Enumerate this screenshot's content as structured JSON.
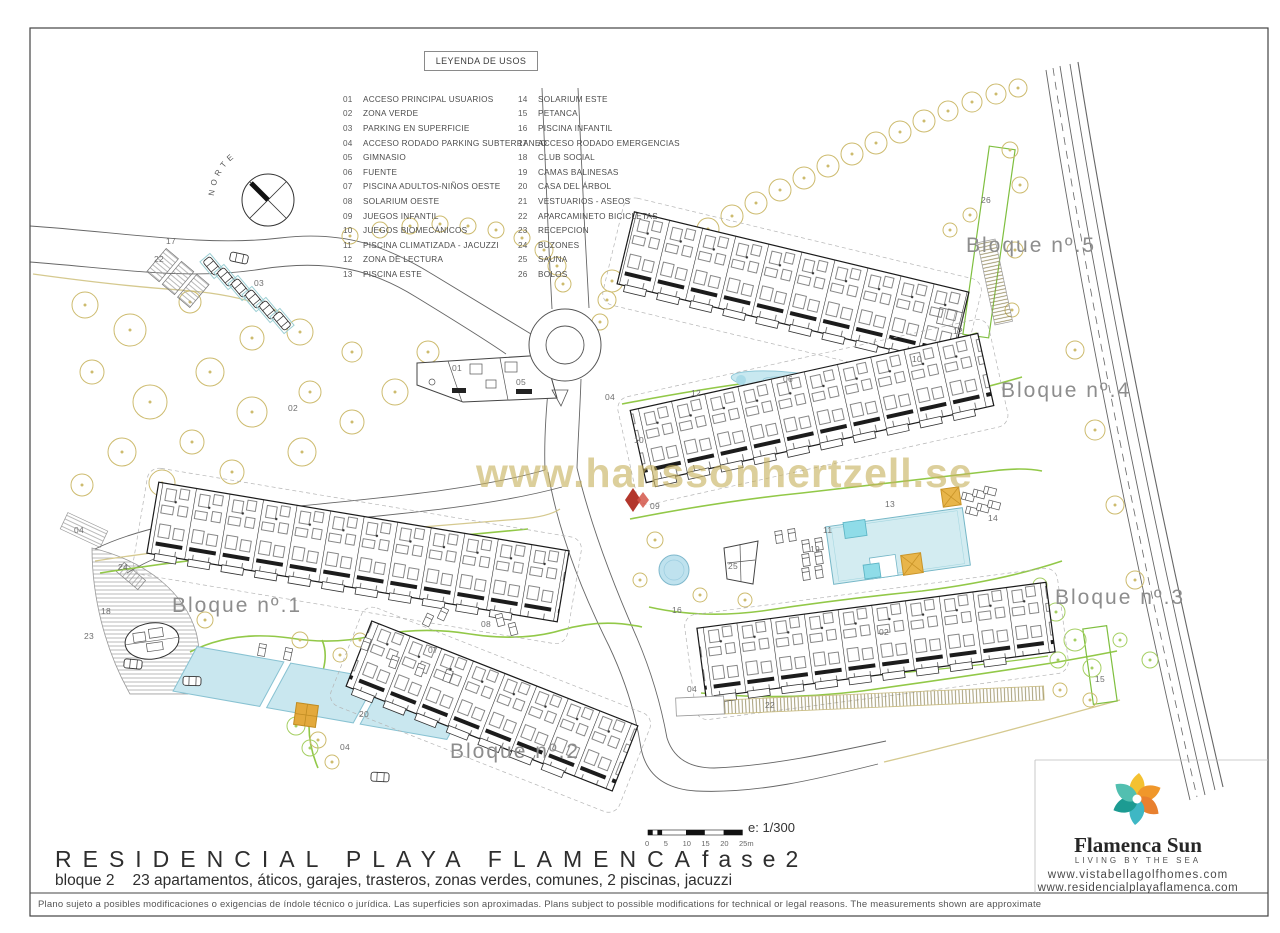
{
  "page": {
    "title_main": "RESIDENCIAL PLAYA FLAMENCA",
    "title_phase": "fase2",
    "subtitle_block": "bloque 2",
    "subtitle_rest": "23 apartamentos, áticos, garajes, trasteros, zonas verdes, comunes, 2 piscinas, jacuzzi",
    "disclaimer": "Plano sujeto a posibles modificaciones o exigencias de índole técnico o jurídica. Las superficies son aproximadas. Plans subject to possible modifications for technical or legal reasons. The measurements shown are approximate"
  },
  "legend": {
    "title": "LEYENDA DE USOS",
    "columns": [
      [
        {
          "num": "01",
          "label": "ACCESO PRINCIPAL USUARIOS"
        },
        {
          "num": "02",
          "label": "ZONA VERDE"
        },
        {
          "num": "03",
          "label": "PARKING EN SUPERFICIE"
        },
        {
          "num": "04",
          "label": "ACCESO RODADO PARKING SUBTERRANEO"
        },
        {
          "num": "05",
          "label": "GIMNASIO"
        },
        {
          "num": "06",
          "label": "FUENTE"
        },
        {
          "num": "07",
          "label": "PISCINA ADULTOS-NIÑOS OESTE"
        },
        {
          "num": "08",
          "label": "SOLARIUM OESTE"
        },
        {
          "num": "09",
          "label": "JUEGOS INFANTIL"
        },
        {
          "num": "10",
          "label": "JUEGOS BIOMECÁNICOS"
        },
        {
          "num": "11",
          "label": "PISCINA CLIMATIZADA - JACUZZI"
        },
        {
          "num": "12",
          "label": "ZONA DE LECTURA"
        },
        {
          "num": "13",
          "label": "PISCINA ESTE"
        }
      ],
      [
        {
          "num": "14",
          "label": "SOLARIUM ESTE"
        },
        {
          "num": "15",
          "label": "PETANCA"
        },
        {
          "num": "16",
          "label": "PISCINA INFANTIL"
        },
        {
          "num": "17",
          "label": "ACCESO RODADO EMERGENCIAS"
        },
        {
          "num": "18",
          "label": "CLUB SOCIAL"
        },
        {
          "num": "19",
          "label": "CAMAS BALINESAS"
        },
        {
          "num": "20",
          "label": "CASA DEL ÁRBOL"
        },
        {
          "num": "21",
          "label": "VESTUARIOS - ASEOS"
        },
        {
          "num": "22",
          "label": "APARCAMINETO BICICLETAS"
        },
        {
          "num": "23",
          "label": "RECEPCION"
        },
        {
          "num": "24",
          "label": "BUZONES"
        },
        {
          "num": "25",
          "label": "SAUNA"
        },
        {
          "num": "26",
          "label": "BOLOS"
        }
      ]
    ]
  },
  "scale": {
    "label": "e: 1/300",
    "ticks": [
      "0",
      "5",
      "10",
      "15",
      "20",
      "25m"
    ]
  },
  "logo": {
    "name": "Flamenca Sun",
    "tagline": "LIVING BY THE SEA",
    "url1": "www.vistabellagolfhomes.com",
    "url2": "www.residencialplayaflamenca.com",
    "colors": [
      "#F4C131",
      "#F0972B",
      "#E8802F",
      "#3EB7C4",
      "#1C9B92",
      "#52BFB0"
    ]
  },
  "watermark": "www.hanssonhertzell.se",
  "plan": {
    "compass_label": "NORTE",
    "accent_green": "#8dc63f",
    "tree_color": "#cdbb6e",
    "pool_color": "#c9e7ef",
    "block_labels": [
      {
        "label": "Bloque nº.5",
        "x": 966,
        "y": 234
      },
      {
        "label": "Bloque nº.4",
        "x": 1001,
        "y": 379
      },
      {
        "label": "Bloque nº.3",
        "x": 1055,
        "y": 586
      },
      {
        "label": "Bloque nº.1",
        "x": 172,
        "y": 594
      },
      {
        "label": "Bloque nº.2",
        "x": 450,
        "y": 740
      }
    ],
    "annotations": [
      {
        "n": "17",
        "x": 166,
        "y": 236
      },
      {
        "n": "22",
        "x": 154,
        "y": 254
      },
      {
        "n": "03",
        "x": 254,
        "y": 278
      },
      {
        "n": "02",
        "x": 288,
        "y": 403
      },
      {
        "n": "01",
        "x": 452,
        "y": 363
      },
      {
        "n": "05",
        "x": 516,
        "y": 377
      },
      {
        "n": "04",
        "x": 605,
        "y": 392
      },
      {
        "n": "12",
        "x": 691,
        "y": 388
      },
      {
        "n": "06",
        "x": 783,
        "y": 374
      },
      {
        "n": "12",
        "x": 953,
        "y": 326
      },
      {
        "n": "10",
        "x": 912,
        "y": 354
      },
      {
        "n": "10",
        "x": 634,
        "y": 435
      },
      {
        "n": "04",
        "x": 687,
        "y": 684
      },
      {
        "n": "22",
        "x": 765,
        "y": 700
      },
      {
        "n": "09",
        "x": 650,
        "y": 501
      },
      {
        "n": "16",
        "x": 672,
        "y": 605
      },
      {
        "n": "25",
        "x": 728,
        "y": 561
      },
      {
        "n": "19",
        "x": 810,
        "y": 544
      },
      {
        "n": "11",
        "x": 823,
        "y": 525
      },
      {
        "n": "13",
        "x": 885,
        "y": 499
      },
      {
        "n": "14",
        "x": 988,
        "y": 513
      },
      {
        "n": "02",
        "x": 879,
        "y": 627
      },
      {
        "n": "15",
        "x": 1095,
        "y": 674
      },
      {
        "n": "26",
        "x": 981,
        "y": 195
      },
      {
        "n": "24",
        "x": 118,
        "y": 562
      },
      {
        "n": "18",
        "x": 101,
        "y": 606
      },
      {
        "n": "23",
        "x": 84,
        "y": 631
      },
      {
        "n": "08",
        "x": 481,
        "y": 619
      },
      {
        "n": "07",
        "x": 428,
        "y": 645
      },
      {
        "n": "20",
        "x": 359,
        "y": 709
      },
      {
        "n": "04",
        "x": 340,
        "y": 742
      },
      {
        "n": "04",
        "x": 74,
        "y": 525
      }
    ]
  }
}
